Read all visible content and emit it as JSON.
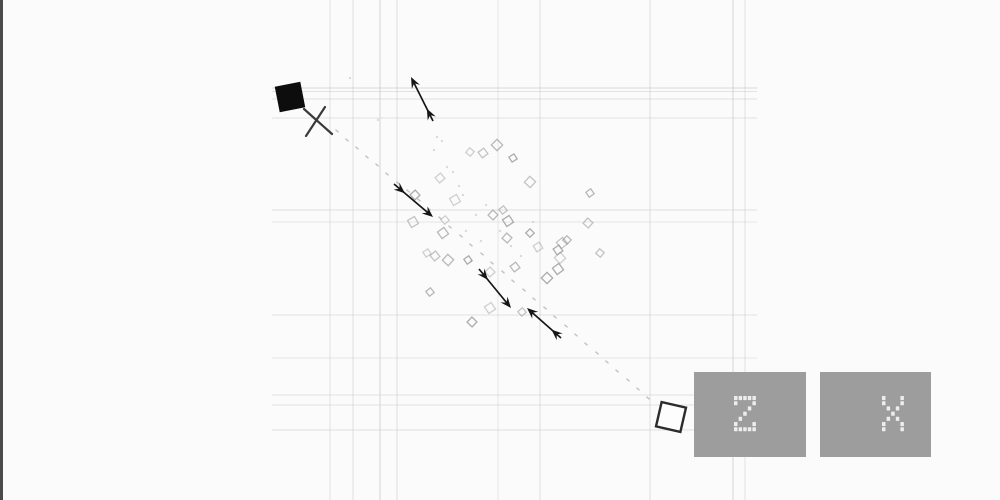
{
  "canvas": {
    "width": 1000,
    "height": 500,
    "background": "#fbfbfb",
    "frame_line_color": "#4a4a4a"
  },
  "grid": {
    "color": "#c9c9c9",
    "h_start_x": 272,
    "h_end_x": 757,
    "vertical_lines": [
      [
        330,
        0.5
      ],
      [
        353,
        0.55
      ],
      [
        380,
        0.8
      ],
      [
        397,
        0.6
      ],
      [
        498,
        0.45
      ],
      [
        540,
        0.55
      ],
      [
        650,
        0.6
      ],
      [
        733,
        0.75
      ],
      [
        745,
        0.5
      ]
    ],
    "horizontal_lines": [
      [
        88,
        0.7
      ],
      [
        91.5,
        0.5
      ],
      [
        99,
        0.55
      ],
      [
        118,
        0.5
      ],
      [
        210,
        0.55
      ],
      [
        222,
        0.4
      ],
      [
        315,
        0.5
      ],
      [
        358,
        0.45
      ],
      [
        395,
        0.5
      ],
      [
        405,
        0.5
      ],
      [
        430,
        0.55
      ]
    ]
  },
  "entities": {
    "player": {
      "icon": "filled-black-square",
      "cx": 290,
      "cy": 97,
      "size": 26,
      "rotation": -11,
      "fill": "#0d0d0d"
    },
    "cross": {
      "icon": "x-marker",
      "color": "#3a3a3a",
      "line1": [
        304,
        109,
        332,
        134
      ],
      "line2": [
        325,
        107,
        306,
        136
      ]
    },
    "target": {
      "icon": "outlined-white-square",
      "cx": 671,
      "cy": 417,
      "size": 25,
      "rotation": 13,
      "fill": "#fdfdfd",
      "stroke": "#2b2b2b"
    }
  },
  "arrows": {
    "color": "#161616",
    "items": [
      {
        "x1": 433,
        "y1": 121,
        "x2": 411,
        "y2": 77
      },
      {
        "x1": 394,
        "y1": 184,
        "x2": 433,
        "y2": 217
      },
      {
        "x1": 479,
        "y1": 269,
        "x2": 511,
        "y2": 308
      },
      {
        "x1": 561,
        "y1": 338,
        "x2": 527,
        "y2": 308
      }
    ]
  },
  "diamonds": {
    "stroke": "#999999",
    "points": [
      [
        470,
        152
      ],
      [
        483,
        153
      ],
      [
        497,
        145
      ],
      [
        513,
        158
      ],
      [
        440,
        178
      ],
      [
        530,
        182
      ],
      [
        590,
        193
      ],
      [
        415,
        195
      ],
      [
        455,
        200
      ],
      [
        503,
        210
      ],
      [
        493,
        215
      ],
      [
        508,
        221
      ],
      [
        445,
        220
      ],
      [
        588,
        223
      ],
      [
        443,
        233
      ],
      [
        530,
        233
      ],
      [
        538,
        247
      ],
      [
        562,
        243
      ],
      [
        567,
        240
      ],
      [
        558,
        250
      ],
      [
        560,
        258
      ],
      [
        600,
        253
      ],
      [
        515,
        267
      ],
      [
        547,
        278
      ],
      [
        427,
        253
      ],
      [
        435,
        256
      ],
      [
        448,
        260
      ],
      [
        468,
        260
      ],
      [
        490,
        272
      ],
      [
        413,
        222
      ],
      [
        430,
        292
      ],
      [
        472,
        322
      ],
      [
        490,
        308
      ],
      [
        522,
        312
      ],
      [
        507,
        238
      ],
      [
        558,
        269
      ]
    ]
  },
  "trail": {
    "color": "#b0b0b0",
    "dots": [
      [
        337,
        131
      ],
      [
        347,
        140
      ],
      [
        357,
        148
      ],
      [
        367,
        157
      ],
      [
        377,
        165
      ],
      [
        387,
        174
      ],
      [
        398,
        183
      ],
      [
        408,
        191
      ],
      [
        419,
        200
      ],
      [
        429,
        209
      ],
      [
        440,
        218
      ],
      [
        450,
        227
      ],
      [
        461,
        236
      ],
      [
        471,
        245
      ],
      [
        482,
        254
      ],
      [
        492,
        263
      ],
      [
        503,
        272
      ],
      [
        513,
        281
      ],
      [
        524,
        290
      ],
      [
        534,
        299
      ],
      [
        545,
        308
      ],
      [
        555,
        317
      ],
      [
        566,
        326
      ],
      [
        576,
        335
      ],
      [
        586,
        344
      ],
      [
        597,
        353
      ],
      [
        607,
        362
      ],
      [
        617,
        371
      ],
      [
        628,
        380
      ],
      [
        638,
        389
      ],
      [
        648,
        398
      ]
    ]
  },
  "specks": {
    "color": "#c6c6c6",
    "dots": [
      [
        437,
        137
      ],
      [
        442,
        141
      ],
      [
        434,
        150
      ],
      [
        447,
        167
      ],
      [
        453,
        172
      ],
      [
        459,
        186
      ],
      [
        463,
        195
      ],
      [
        476,
        215
      ],
      [
        486,
        205
      ],
      [
        466,
        231
      ],
      [
        481,
        241
      ],
      [
        500,
        231
      ],
      [
        511,
        246
      ],
      [
        471,
        261
      ],
      [
        521,
        256
      ],
      [
        533,
        222
      ],
      [
        350,
        78
      ],
      [
        378,
        120
      ]
    ]
  },
  "controls": {
    "button_color": "#9d9d9d",
    "glyph_color": "#ededed",
    "buttons": [
      {
        "key": "Z",
        "x": 694,
        "y": 372,
        "w": 112,
        "h": 85,
        "glyph_offset_x": -5
      },
      {
        "key": "X",
        "x": 820,
        "y": 372,
        "w": 111,
        "h": 85,
        "glyph_offset_x": 18
      }
    ]
  }
}
